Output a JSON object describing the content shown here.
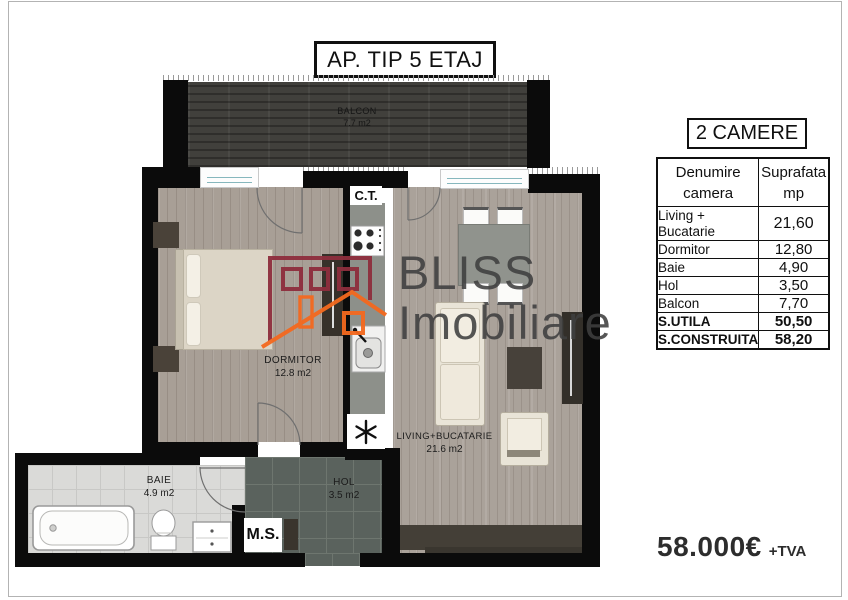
{
  "title": "AP. TIP 5 ETAJ",
  "plan": {
    "ct_label": "C.T.",
    "ms_label": "M.S.",
    "rooms": {
      "balcon": {
        "name": "BALCON",
        "area": "7.7 m2"
      },
      "dormitor": {
        "name": "DORMITOR",
        "area": "12.8 m2"
      },
      "living": {
        "name": "LIVING+BUCATARIE",
        "area": "21.6 m2"
      },
      "baie": {
        "name": "BAIE",
        "area": "4.9 m2"
      },
      "hol": {
        "name": "HOL",
        "area": "3.5 m2"
      }
    }
  },
  "watermark": {
    "line1": "BLISS",
    "line2": "Imobiliare"
  },
  "panel": {
    "header": "2 CAMERE",
    "table": {
      "header": {
        "name_l1": "Denumire",
        "name_l2": "camera",
        "val_l1": "Suprafata",
        "val_l2": "mp"
      },
      "rows": [
        {
          "name": "Living + Bucatarie",
          "value": "21,60"
        },
        {
          "name": "Dormitor",
          "value": "12,80"
        },
        {
          "name": "Baie",
          "value": "4,90"
        },
        {
          "name": "Hol",
          "value": "3,50"
        },
        {
          "name": "Balcon",
          "value": "7,70"
        },
        {
          "name": "S.UTILA",
          "value": "50,50"
        },
        {
          "name": "S.CONSTRUITA",
          "value": "58,20"
        }
      ]
    },
    "price": "58.000€",
    "price_suffix": "+TVA"
  },
  "colors": {
    "wall": "#0b0b0b",
    "logo_maroon": "#8e2e3d",
    "logo_orange": "#f4691e",
    "balcony_floor": "#41403c",
    "hol_tile": "#5a625d"
  }
}
